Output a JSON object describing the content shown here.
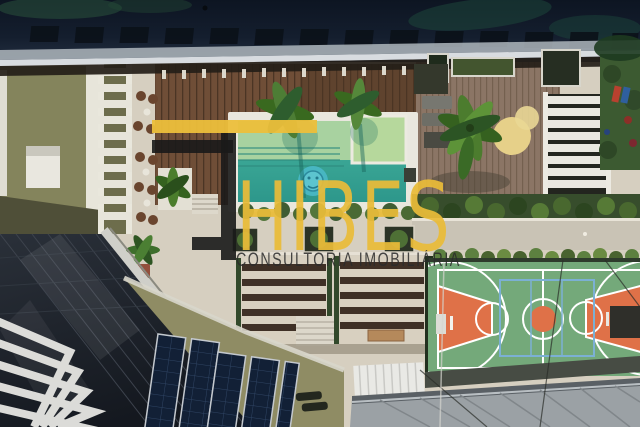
{
  "meta": {
    "type": "aerial-drone-photograph",
    "description": "Top-down aerial view of a condominium leisure roof area: swimming pool with mosaic medallion, wooden decks, palm trees, pergolas, basketball court, lawn playground, solar panels, residential tower and metal roofs, overlaid with a real-estate watermark"
  },
  "watermark": {
    "brand_name": "THIBES",
    "wordmark_text": "HIBES",
    "tagline_text": "CONSULTORIA IMOBILIÁRIA",
    "logo_colors": {
      "gold": "#ECBF3B",
      "black": "#1A1A1A"
    },
    "tagline_color": "#2B2B2B"
  },
  "scene": {
    "features": [
      "dark-glass-canopy-with-palm-reflections",
      "olive-green-flat-roof",
      "white-ladder-pergola",
      "round-rattan-chairs",
      "timber-pool-deck",
      "swimming-pool-with-shallow-shelf-and-spa",
      "pool-mosaic-medallion",
      "overhanging-palm-trees",
      "white-slatted-pergola",
      "lawn-with-playground",
      "hedge-rows-and-walkways",
      "garden-pergolas-with-dark-beams",
      "residential-tower-with-chevron-balconies",
      "rooftop-solar-panels",
      "basketball-sports-court",
      "grey-standing-seam-metal-roof"
    ],
    "colors": {
      "deck_cream": "#D6CFC0",
      "wood_deck": "#6F4E37",
      "weathered_deck": "#8B7565",
      "pool_teal": "#3FAE9B",
      "pool_shallow": "#A8D2A0",
      "spa_green": "#B6D89C",
      "medallion_blue": "#49B7C4",
      "olive_roof": "#8A8A60",
      "canopy_glass": "#101A2A",
      "lawn_green": "#3C5A31",
      "court_green": "#74A97A",
      "court_orange": "#DF7148",
      "court_blue_lines": "#7CB0D4",
      "metal_roof": "#9BA1A5",
      "solar_panel": "#122036",
      "tower_glass": "#232830",
      "balcony_white": "#E8E8E4"
    }
  }
}
